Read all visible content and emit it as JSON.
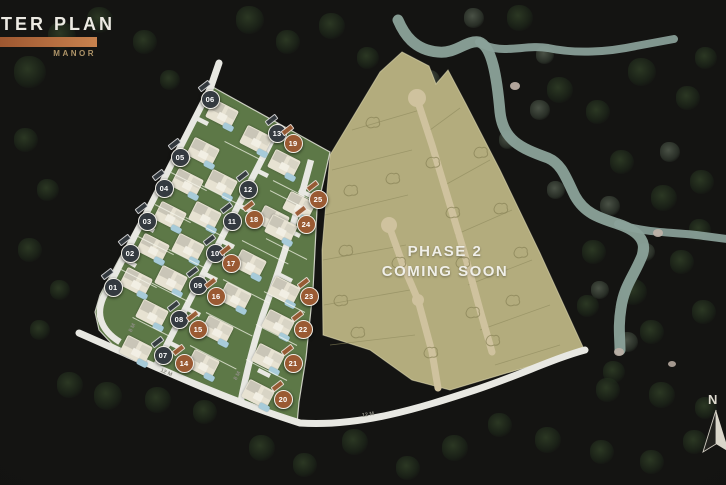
{
  "header": {
    "title": "TER PLAN",
    "subtitle": "MANOR"
  },
  "phase2_label": {
    "line1": "PHASE 2",
    "line2": "COMING SOON"
  },
  "compass": {
    "label": "N"
  },
  "road_labels": [
    {
      "text": "8 M",
      "x": 128,
      "y": 325,
      "rot": -64
    },
    {
      "text": "12 M",
      "x": 160,
      "y": 370,
      "rot": 24
    },
    {
      "text": "8 M",
      "x": 233,
      "y": 373,
      "rot": -62
    },
    {
      "text": "12 M",
      "x": 362,
      "y": 412,
      "rot": -9
    }
  ],
  "colors": {
    "accent_copper": "#b4683c",
    "marker_dark": "#343a40",
    "marker_orange": "#9a5a33",
    "phase1_green": "#5d7847",
    "phase2_khaki": "#b3ac7d",
    "river": "#8ba29a",
    "road_white": "#e8e8e2"
  },
  "lots": [
    {
      "id": "01",
      "type": "dark",
      "col": "L",
      "x": 112,
      "y": 286
    },
    {
      "id": "02",
      "type": "dark",
      "col": "L",
      "x": 129,
      "y": 252
    },
    {
      "id": "03",
      "type": "dark",
      "col": "L",
      "x": 146,
      "y": 220
    },
    {
      "id": "04",
      "type": "dark",
      "col": "L",
      "x": 163,
      "y": 187
    },
    {
      "id": "05",
      "type": "dark",
      "col": "L",
      "x": 179,
      "y": 156
    },
    {
      "id": "06",
      "type": "dark",
      "col": "T",
      "x": 209,
      "y": 98
    },
    {
      "id": "07",
      "type": "dark",
      "col": "M",
      "x": 162,
      "y": 354
    },
    {
      "id": "08",
      "type": "dark",
      "col": "M",
      "x": 178,
      "y": 318
    },
    {
      "id": "09",
      "type": "dark",
      "col": "M",
      "x": 197,
      "y": 284
    },
    {
      "id": "10",
      "type": "dark",
      "col": "M",
      "x": 214,
      "y": 252
    },
    {
      "id": "11",
      "type": "dark",
      "col": "M",
      "x": 231,
      "y": 220
    },
    {
      "id": "12",
      "type": "dark",
      "col": "M",
      "x": 247,
      "y": 188
    },
    {
      "id": "13",
      "type": "dark",
      "col": "M",
      "x": 276,
      "y": 132,
      "ho": [
        -20,
        8
      ]
    },
    {
      "id": "14",
      "type": "orange",
      "col": "MO",
      "x": 183,
      "y": 362
    },
    {
      "id": "15",
      "type": "orange",
      "col": "MO",
      "x": 197,
      "y": 328
    },
    {
      "id": "16",
      "type": "orange",
      "col": "MO",
      "x": 215,
      "y": 295
    },
    {
      "id": "17",
      "type": "orange",
      "col": "MO",
      "x": 230,
      "y": 262
    },
    {
      "id": "18",
      "type": "orange",
      "col": "MO",
      "x": 253,
      "y": 218
    },
    {
      "id": "19",
      "type": "orange",
      "col": "MO",
      "x": 292,
      "y": 142,
      "ho": [
        -8,
        22
      ]
    },
    {
      "id": "20",
      "type": "orange",
      "col": "RO",
      "x": 282,
      "y": 398
    },
    {
      "id": "21",
      "type": "orange",
      "col": "RO",
      "x": 292,
      "y": 362
    },
    {
      "id": "22",
      "type": "orange",
      "col": "RO",
      "x": 302,
      "y": 328
    },
    {
      "id": "23",
      "type": "orange",
      "col": "RO",
      "x": 308,
      "y": 295
    },
    {
      "id": "24",
      "type": "orange",
      "col": "RO",
      "x": 305,
      "y": 223,
      "ho": [
        -24,
        6
      ]
    },
    {
      "id": "25",
      "type": "orange",
      "col": "RO",
      "x": 317,
      "y": 198,
      "ho": [
        -18,
        8
      ]
    }
  ]
}
